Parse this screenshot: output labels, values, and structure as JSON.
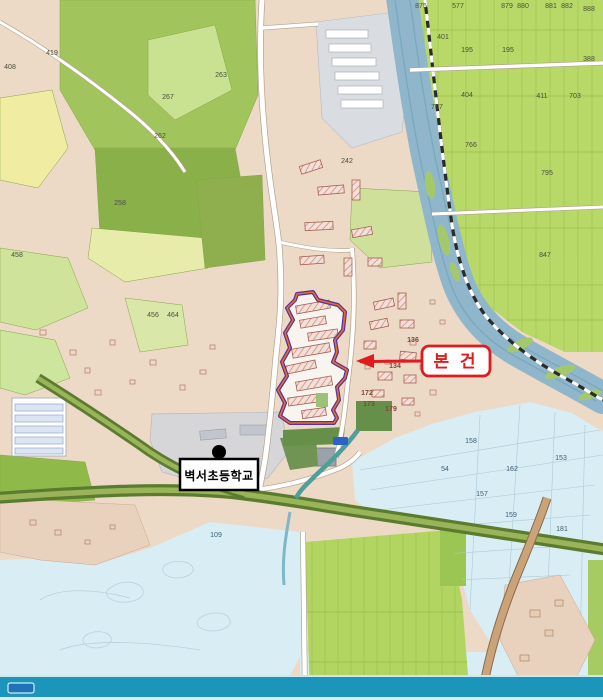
{
  "annotations": {
    "subject": {
      "label": "본 건"
    },
    "school": {
      "label": "벽서초등학교"
    }
  },
  "colors": {
    "annotation_red": "#e01b1d",
    "subject_outline_purple": "#5630a8",
    "subject_outline_orange": "#e2711d",
    "urban_tan": "#ecd9c6",
    "forest_green": "#9fc257",
    "paddy_green": "#b8d967",
    "paddy_blue": "#d9edf4",
    "river_blue": "#8fb6ca",
    "bottom_stream_teal": "#1b96ba",
    "school_gray": "#d6d6d8",
    "tree_road_green": "#5b7c2f"
  },
  "icons": [
    {
      "name": "school-point-marker"
    },
    {
      "name": "route-badge"
    },
    {
      "name": "stream-name-badge"
    }
  ],
  "parcel_labels": [
    {
      "t": "267",
      "x": 168,
      "y": 99
    },
    {
      "t": "262",
      "x": 160,
      "y": 138
    },
    {
      "t": "263",
      "x": 221,
      "y": 77
    },
    {
      "t": "258",
      "x": 120,
      "y": 205
    },
    {
      "t": "242",
      "x": 347,
      "y": 163
    },
    {
      "t": "419",
      "x": 52,
      "y": 55
    },
    {
      "t": "408",
      "x": 10,
      "y": 69
    },
    {
      "t": "456",
      "x": 153,
      "y": 317
    },
    {
      "t": "464",
      "x": 173,
      "y": 317
    },
    {
      "t": "458",
      "x": 17,
      "y": 257
    },
    {
      "t": "875",
      "x": 421,
      "y": 8
    },
    {
      "t": "577",
      "x": 458,
      "y": 8
    },
    {
      "t": "879",
      "x": 507,
      "y": 8
    },
    {
      "t": "880",
      "x": 523,
      "y": 8
    },
    {
      "t": "881",
      "x": 551,
      "y": 8
    },
    {
      "t": "882",
      "x": 567,
      "y": 8
    },
    {
      "t": "888",
      "x": 589,
      "y": 11
    },
    {
      "t": "401",
      "x": 443,
      "y": 39
    },
    {
      "t": "195",
      "x": 467,
      "y": 52
    },
    {
      "t": "195",
      "x": 508,
      "y": 52
    },
    {
      "t": "388",
      "x": 589,
      "y": 61
    },
    {
      "t": "404",
      "x": 467,
      "y": 97
    },
    {
      "t": "411",
      "x": 542,
      "y": 98
    },
    {
      "t": "703",
      "x": 575,
      "y": 98
    },
    {
      "t": "757",
      "x": 437,
      "y": 109
    },
    {
      "t": "766",
      "x": 471,
      "y": 147
    },
    {
      "t": "795",
      "x": 547,
      "y": 175
    },
    {
      "t": "847",
      "x": 545,
      "y": 257
    },
    {
      "t": "136",
      "x": 413,
      "y": 342,
      "cls": "tan"
    },
    {
      "t": "134",
      "x": 395,
      "y": 368,
      "cls": "tan"
    },
    {
      "t": "172",
      "x": 367,
      "y": 395,
      "cls": "tan"
    },
    {
      "t": "173",
      "x": 369,
      "y": 406,
      "cls": "tan"
    },
    {
      "t": "179",
      "x": 391,
      "y": 411,
      "cls": "tan"
    },
    {
      "t": "158",
      "x": 471,
      "y": 443,
      "cls": "blue"
    },
    {
      "t": "54",
      "x": 445,
      "y": 471,
      "cls": "blue"
    },
    {
      "t": "162",
      "x": 512,
      "y": 471,
      "cls": "blue"
    },
    {
      "t": "153",
      "x": 561,
      "y": 460,
      "cls": "blue"
    },
    {
      "t": "157",
      "x": 482,
      "y": 496,
      "cls": "blue"
    },
    {
      "t": "159",
      "x": 511,
      "y": 517,
      "cls": "blue"
    },
    {
      "t": "181",
      "x": 562,
      "y": 531,
      "cls": "blue"
    },
    {
      "t": "109",
      "x": 216,
      "y": 537,
      "cls": "blue"
    }
  ]
}
